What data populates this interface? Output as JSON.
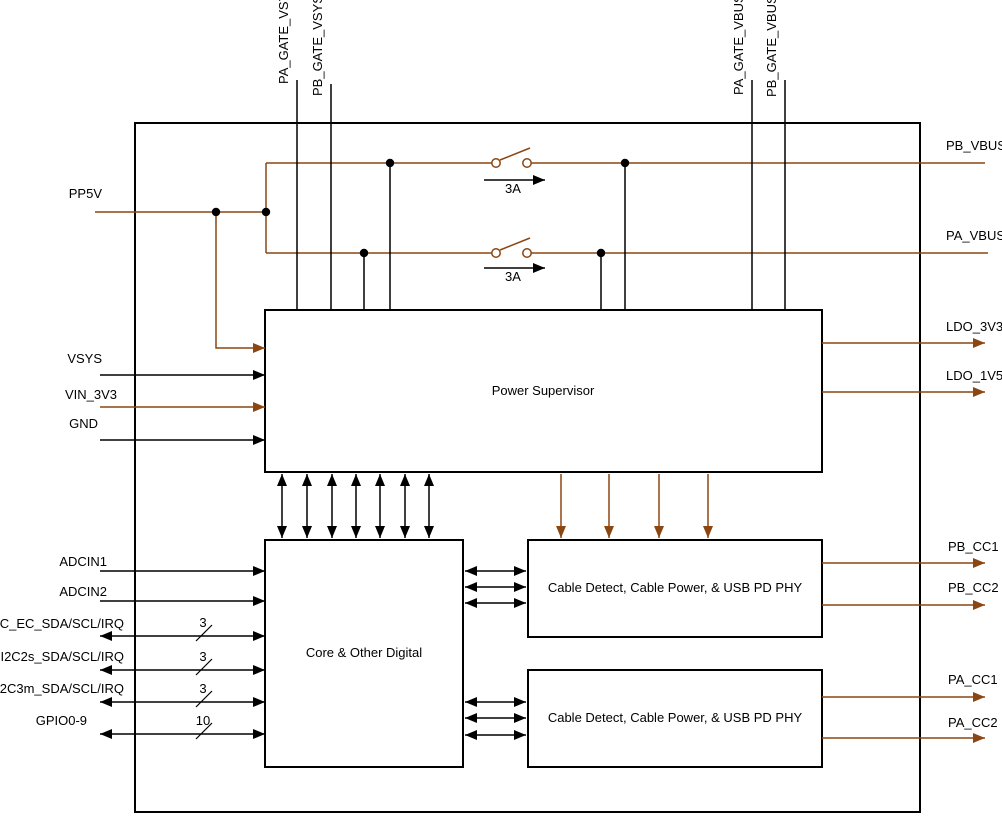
{
  "diagram": {
    "type": "functional-block-diagram",
    "description": "USB PD controller power/block diagram"
  },
  "colors": {
    "power_wire": "#8C4612",
    "signal_wire": "#000000",
    "block_border": "#000000",
    "background": "#FFFFFF"
  },
  "pins": {
    "pa_gate_vsys": "PA_GATE_VSYS",
    "pb_gate_vsys": "PB_GATE_VSYS",
    "pa_gate_vbus": "PA_GATE_VBUS",
    "pb_gate_vbus": "PB_GATE_VBUS",
    "pp5v": "PP5V",
    "vsys": "VSYS",
    "vin_3v3": "VIN_3V3",
    "gnd": "GND",
    "adcin1": "ADCIN1",
    "adcin2": "ADCIN2",
    "i2c_ec": "I2C_EC_SDA/SCL/IRQ",
    "i2c2s": "I2C2s_SDA/SCL/IRQ",
    "i2c3m": "I2C3m_SDA/SCL/IRQ",
    "gpio": "GPIO0-9",
    "pb_vbus": "PB_VBUS",
    "pa_vbus": "PA_VBUS",
    "ldo_3v3": "LDO_3V3",
    "ldo_1v5": "LDO_1V5",
    "pb_cc1": "PB_CC1",
    "pb_cc2": "PB_CC2",
    "pa_cc1": "PA_CC1",
    "pa_cc2": "PA_CC2"
  },
  "blocks": {
    "power_supervisor": "Power Supervisor",
    "core_digital": "Core & Other Digital",
    "pd_phy_b": "Cable Detect, Cable Power, & USB PD PHY",
    "pd_phy_a": "Cable Detect, Cable Power, & USB PD PHY"
  },
  "annotations": {
    "switch_b_rating": "3A",
    "switch_a_rating": "3A",
    "i2c_ec_width": "3",
    "i2c2s_width": "3",
    "i2c3m_width": "3",
    "gpio_width": "10"
  }
}
